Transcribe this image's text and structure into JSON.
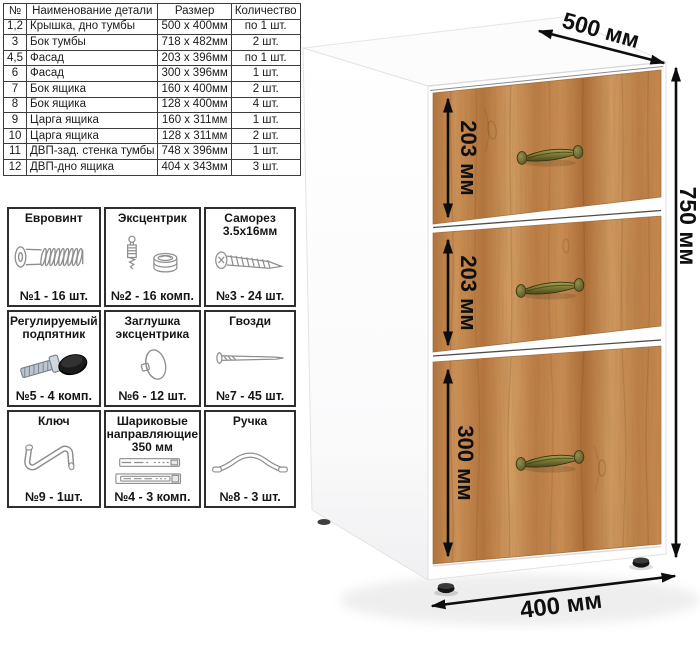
{
  "parts_table": {
    "headers": [
      "№",
      "Наименование детали",
      "Размер",
      "Количество"
    ],
    "rows": [
      [
        "1,2",
        "Крышка, дно тумбы",
        "500 х 400мм",
        "по 1 шт."
      ],
      [
        "3",
        "Бок тумбы",
        "718 х 482мм",
        "2 шт."
      ],
      [
        "4,5",
        "Фасад",
        "203 х 396мм",
        "по 1 шт."
      ],
      [
        "6",
        "Фасад",
        "300 х 396мм",
        "1 шт."
      ],
      [
        "7",
        "Бок ящика",
        "160 х 400мм",
        "2 шт."
      ],
      [
        "8",
        "Бок ящика",
        "128 х 400мм",
        "4 шт."
      ],
      [
        "9",
        "Царга ящика",
        "160 х 311мм",
        "1 шт."
      ],
      [
        "10",
        "Царга ящика",
        "128 х 311мм",
        "2 шт."
      ],
      [
        "11",
        "ДВП-зад. стенка тумбы",
        "748 х 396мм",
        "1 шт."
      ],
      [
        "12",
        "ДВП-дно ящика",
        "404 х 343мм",
        "3 шт."
      ]
    ]
  },
  "hardware": {
    "items": [
      {
        "title": "Евровинт",
        "icon": "euro-screw-icon",
        "qty": "№1 - 16 шт."
      },
      {
        "title": "Эксцентрик",
        "icon": "cam-lock-icon",
        "qty": "№2 - 16 комп."
      },
      {
        "title": "Саморез 3.5х16мм",
        "icon": "self-tapping-screw-icon",
        "qty": "№3 - 24 шт."
      },
      {
        "title": "Регулируемый подпятник",
        "icon": "adjustable-foot-icon",
        "qty": "№5 - 4 комп."
      },
      {
        "title": "Заглушка эксцентрика",
        "icon": "cam-cap-icon",
        "qty": "№6 - 12 шт."
      },
      {
        "title": "Гвозди",
        "icon": "nail-icon",
        "qty": "№7 - 45 шт."
      },
      {
        "title": "Ключ",
        "icon": "hex-key-icon",
        "qty": "№9 - 1шт."
      },
      {
        "title": "Шариковые направляющие 350 мм",
        "icon": "ball-slides-icon",
        "qty": "№4 - 3 комп."
      },
      {
        "title": "Ручка",
        "icon": "handle-icon",
        "qty": "№8 - 3 шт."
      }
    ]
  },
  "cabinet": {
    "dimensions": {
      "depth": "500 мм",
      "height": "750 мм",
      "width": "400 мм",
      "drawers": [
        "203 мм",
        "203 мм",
        "300 мм"
      ]
    },
    "colors": {
      "wood": "#c28a52",
      "handle": "#7d7b33",
      "body": "#ffffff",
      "dimension_text": "#111111"
    }
  }
}
